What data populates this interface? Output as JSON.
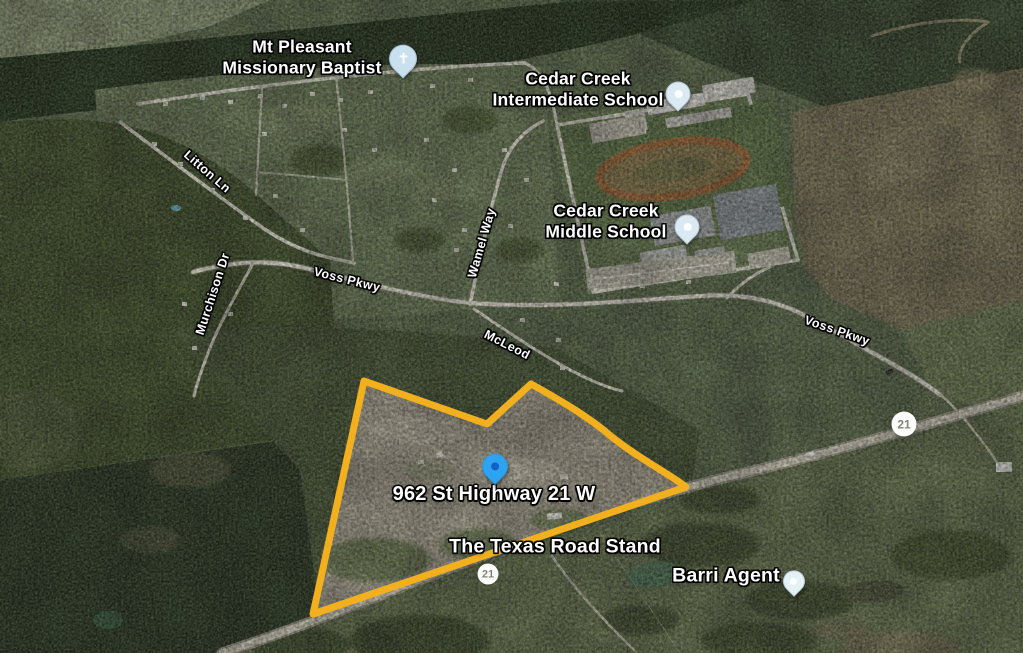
{
  "pois": {
    "church": {
      "label": "Mt Pleasant\nMissionary Baptist"
    },
    "intermediate_school": {
      "label": "Cedar Creek\nIntermediate School"
    },
    "middle_school": {
      "label": "Cedar Creek\nMiddle School"
    },
    "property": {
      "label": "962 St Highway 21 W"
    },
    "road_stand": {
      "label": "The Texas Road Stand"
    },
    "agent": {
      "label": "Barri Agent"
    }
  },
  "streets": {
    "litton": "Litton Ln",
    "murchison": "Murchison Dr",
    "voss_west": "Voss Pkwy",
    "wamel": "Wamel Way",
    "mcleod": "McLeod",
    "voss_east": "Voss Pkwy"
  },
  "highway": {
    "route": "21"
  },
  "icons": {
    "church_glyph": "✝"
  },
  "colors": {
    "parcel_outline": "#F2B01E",
    "property_pin": "#2EA3F2",
    "property_pin_dot": "#1261C4",
    "church_pin": "#C9E0EE",
    "school_pin": "#DBEAF2",
    "agent_pin": "#E4F2F6",
    "pin_dot_white": "#FFFFFF"
  }
}
